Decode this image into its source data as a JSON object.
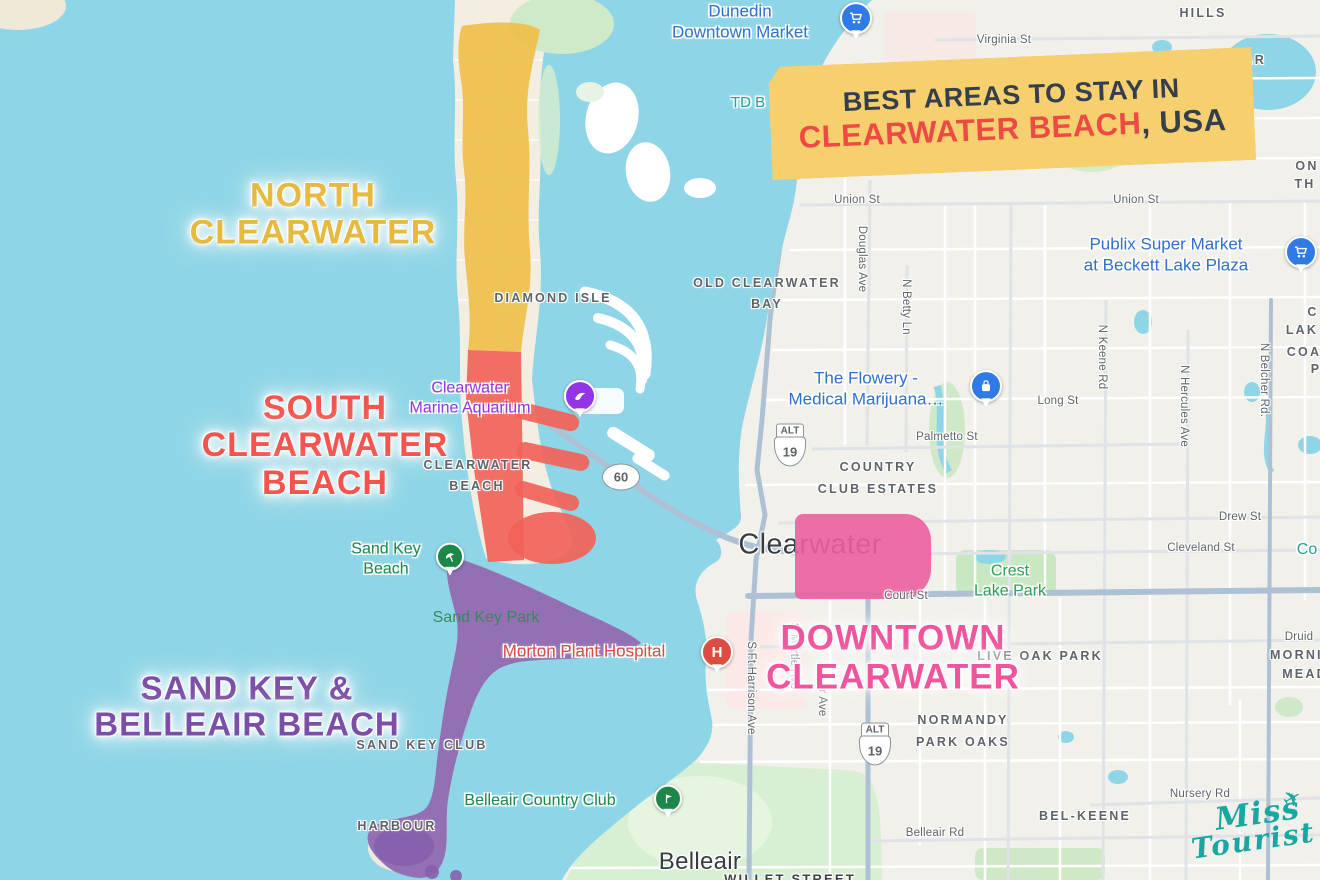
{
  "colors": {
    "water": "#8ed6e7",
    "land": "#f2f0ea",
    "north_region": "#eec04a",
    "south_region": "#f2625a",
    "sandkey_region": "#8a63b0",
    "downtown_region": "#ec5f9e",
    "poi_blue": "#2f6fd0",
    "poi_purple": "#9334e6",
    "poi_green": "#1d8649",
    "poi_red": "#dd4b43",
    "banner_bg": "#f6d06e"
  },
  "banner": {
    "line1": "BEST AREAS TO STAY IN",
    "highlight": "CLEARWATER BEACH",
    "suffix": ", USA"
  },
  "region_titles": {
    "north": {
      "l1": "NORTH",
      "l2": "CLEARWATER"
    },
    "south": {
      "l1": "SOUTH",
      "l2": "CLEARWATER",
      "l3": "BEACH"
    },
    "sandkey": {
      "l1": "SAND KEY &",
      "l2": "BELLEAIR BEACH"
    },
    "downtown": {
      "l1": "DOWNTOWN",
      "l2": "CLEARWATER"
    }
  },
  "cities": {
    "clearwater": "Clearwater",
    "belleair": "Belleair"
  },
  "areas": {
    "hills": "HILLS",
    "greenbriar": "GREENBRIAR",
    "diamond_isle": "DIAMOND ISLE",
    "old_bay_1": "OLD CLEARWATER",
    "old_bay_2": "BAY",
    "beach_1": "CLEARWATER",
    "beach_2": "BEACH",
    "country_1": "COUNTRY",
    "country_2": "CLUB ESTATES",
    "live_oak": "LIVE OAK PARK",
    "mornin": "MORNIN",
    "mead": "MEAD",
    "normandy_1": "NORMANDY",
    "normandy_2": "PARK OAKS",
    "bel_keene": "BEL-KEENE",
    "sand_key_club": "SAND KEY CLUB",
    "harbour": "HARBOUR",
    "frag_on": "ON",
    "frag_th": "TH",
    "frag_c": "C",
    "frag_lak": "LAK",
    "frag_coa": "COA",
    "frag_p": "P",
    "willet": "WILLET STREET"
  },
  "streets": {
    "virginia": "Virginia St",
    "union_w": "Union St",
    "union_e": "Union St",
    "douglas": "Douglas Ave",
    "betty": "N Betty Ln",
    "long": "Long St",
    "keene": "N Keene Rd",
    "hercules": "N Hercules Ave",
    "belcher": "N Belcher Rd.",
    "palmetto": "Palmetto St",
    "drew": "Drew St",
    "cleveland": "Cleveland St",
    "court": "Court St",
    "druid": "Druid",
    "ft_harrison": "S Ft Harrison Ave",
    "myrtle": "S Myrtle Ave",
    "jr_ave": "Jr Ave",
    "belleair_rd": "Belleair Rd",
    "nursery": "Nursery Rd"
  },
  "pois": {
    "dunedin": {
      "l1": "Dunedin",
      "l2": "Downtown Market"
    },
    "td": "TD B",
    "publix": {
      "l1": "Publix Super Market",
      "l2": "at Beckett Lake Plaza"
    },
    "flowery": {
      "l1": "The Flowery -",
      "l2": "Medical Marijuana…"
    },
    "aquarium": {
      "l1": "Clearwater",
      "l2": "Marine Aquarium"
    },
    "sand_key_beach": {
      "l1": "Sand Key",
      "l2": "Beach"
    },
    "sand_key_park": "Sand Key Park",
    "crest": {
      "l1": "Crest",
      "l2": "Lake Park"
    },
    "belleair_cc": "Belleair Country Club",
    "morton": "Morton Plant Hospital",
    "co": "Co"
  },
  "shields": {
    "alt": "ALT",
    "r19": "19",
    "r60": "60"
  },
  "logo": {
    "word1": "Miss",
    "word2": "Tourist",
    "plane": "✈"
  }
}
